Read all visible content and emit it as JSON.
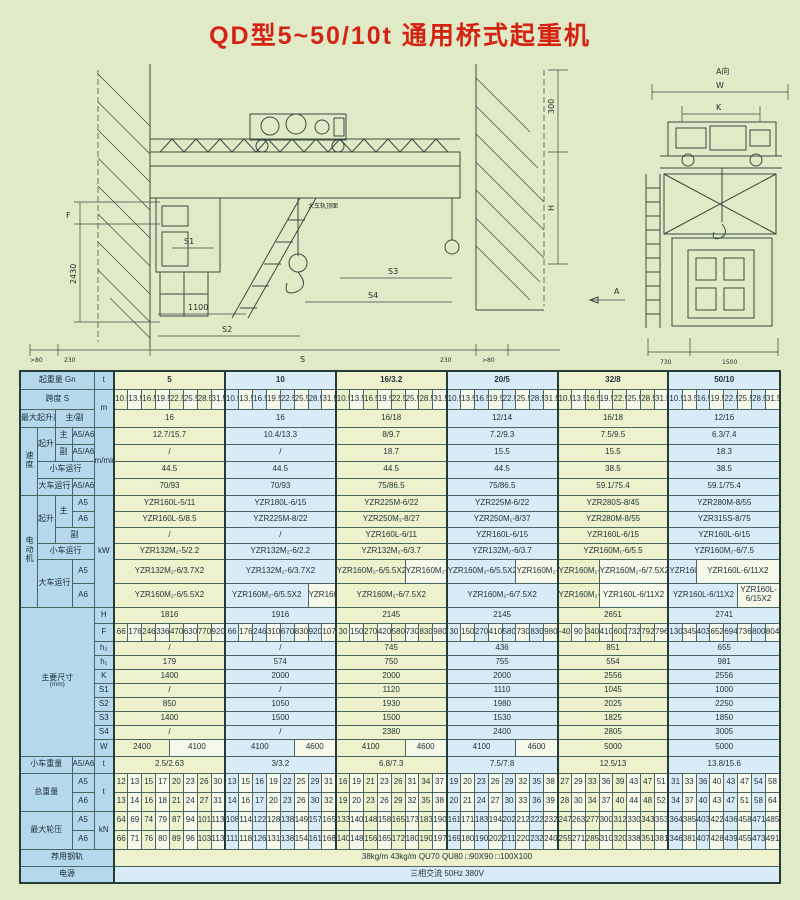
{
  "page": {
    "title": "QD型5~50/10t 通用桥式起重机"
  },
  "colors": {
    "title": "#d42313",
    "background": "#e0eac7",
    "label_bg": "#b4d9ec",
    "row_yellow": "#edf2cd",
    "row_blue": "#d9ebf7",
    "cell_white": "#f6f8ea",
    "grid": "#4a6562"
  },
  "drawing": {
    "front": {
      "f": "F",
      "h2430": "2430",
      "s1": "S1",
      "d1100": "1100",
      "s2": "S2",
      "gt80_left": ">80",
      "d230_left": "230",
      "span": "S",
      "d230_right": "230",
      "gt80_right": ">80",
      "d300": "300",
      "h": "H",
      "s3": "S3",
      "s4": "S4",
      "rail_top": "大车轨顶面",
      "section": "A"
    },
    "side": {
      "view": "A向",
      "w": "W",
      "k": "K",
      "d730": "730",
      "d1500": "1500"
    }
  },
  "table": {
    "row_labels": {
      "capacity": "起重量 Gn",
      "capacity_unit": "t",
      "span": "跨度 S",
      "span_unit": "m",
      "lift_height": "最大起升高度",
      "lift_height_sub": "主/副",
      "speed": "速度",
      "speed_unit": "m/min",
      "hoist": "起升",
      "main": "主",
      "aux": "副",
      "a5a6": "A5/A6",
      "a5": "A5",
      "a6": "A6",
      "trolley_travel": "小车运行",
      "bridge_travel": "大车运行",
      "motor": "电动机",
      "motor_unit": "kW",
      "dims": "主要尺寸",
      "dims_unit": "(mm)",
      "dim_names": [
        "H",
        "F",
        "h₂",
        "h₁",
        "K",
        "S1",
        "S2",
        "S3",
        "S4",
        "W"
      ],
      "trolley_weight": "小车重量",
      "trolley_weight_unit": "t",
      "total_weight": "总重量",
      "total_weight_unit": "t",
      "wheel_load": "最大轮压",
      "wheel_load_unit": "kN",
      "rail": "荐用钢轨",
      "power": "电源"
    },
    "capacities": [
      "5",
      "10",
      "16/3.2",
      "20/5",
      "32/8",
      "50/10"
    ],
    "spans": [
      "10.5",
      "13.5",
      "16.5",
      "19.5",
      "22.5",
      "25.5",
      "28.5",
      "31.5"
    ],
    "lift_height": [
      "16",
      "16",
      "16/18",
      "12/14",
      "16/18",
      "12/16"
    ],
    "speed_main": [
      "12.7/15.7",
      "10.4/13.3",
      "8/9.7",
      "7.2/9.3",
      "7.5/9.5",
      "6.3/7.4"
    ],
    "speed_aux": [
      "/",
      "/",
      "18.7",
      "15.5",
      "15.5",
      "18.3"
    ],
    "speed_trolley": [
      "44.5",
      "44.5",
      "44.5",
      "44.5",
      "38.5",
      "38.5"
    ],
    "speed_bridge": [
      "70/93",
      "70/93",
      "75/86.5",
      "75/86.5",
      "59.1/75.4",
      "59.1/75.4"
    ],
    "motor_main_a5": [
      "YZR160L-5/11",
      "YZR180L-6/15",
      "YZR225M-6/22",
      "YZR225M-6/22",
      "YZR280S-8/45",
      "YZR280M-8/55"
    ],
    "motor_main_a6": [
      "YZR160L-5/8.5",
      "YZR225M-8/22",
      "YZR250M₁-8/27",
      "YZR250M₁-8/37",
      "YZR280M-8/55",
      "YZR315S-8/75"
    ],
    "motor_aux": [
      "/",
      "/",
      "YZR160L-6/11",
      "YZR160L-6/15",
      "YZR160L-6/15",
      "YZR160L-6/15"
    ],
    "motor_trolley": [
      "YZR132M₂-5/2.2",
      "YZR132M₂-6/2.2",
      "YZR132M₂-6/3.7",
      "YZR132M₂-6/3.7",
      "YZR160M₁-6/5.5",
      "YZR160M₂-6/7.5"
    ],
    "motor_bridge_a5": [
      [
        "YZR132M₂-6/3.7X2"
      ],
      [
        "YZR132M₂-6/3.7X2"
      ],
      [
        "YZR160M₂-6/5.5X2",
        "YZR160M₂-6/7.5X2"
      ],
      [
        "YZR160M₂-6/5.5X2",
        "YZR160M₂-6/7.5X2"
      ],
      [
        "YZR160M₁-6/5.5X2",
        "YZR160M₂-6/7.5X2"
      ],
      [
        "YZR160M₂-6/7.5X2",
        "YZR160L-6/11X2"
      ]
    ],
    "motor_bridge_a6": [
      [
        "YZR160M₂-6/5.5X2"
      ],
      [
        "YZR160M₂-6/5.5X2",
        "YZR160M₂-6/7.5X2"
      ],
      [
        "YZR160M₂-6/7.5X2"
      ],
      [
        "YZR160M₂-6/7.5X2"
      ],
      [
        "YZR160M₂-6/7.5X2",
        "YZR160L-6/11X2"
      ],
      [
        "YZR160L-6/11X2",
        "YZR160L-6/15X2"
      ]
    ],
    "dim_H": [
      "1816",
      "1916",
      "2145",
      "2145",
      "2651",
      "2741"
    ],
    "dim_F": [
      [
        "66",
        "176",
        "246",
        "336",
        "470",
        "630",
        "770",
        "920"
      ],
      [
        "66",
        "176",
        "246",
        "310",
        "670",
        "830",
        "920",
        "1070"
      ],
      [
        "30",
        "150",
        "270",
        "420",
        "580",
        "730",
        "830",
        "980"
      ],
      [
        "30",
        "150",
        "270",
        "410",
        "580",
        "730",
        "830",
        "980"
      ],
      [
        "-40",
        "90",
        "340",
        "410",
        "600",
        "732",
        "792",
        "796"
      ],
      [
        "130",
        "345",
        "403",
        "652",
        "694",
        "736",
        "800",
        "804"
      ]
    ],
    "dim_h2": [
      "/",
      "/",
      "745",
      "436",
      "851",
      "655"
    ],
    "dim_h1": [
      "179",
      "574",
      "750",
      "755",
      "554",
      "981"
    ],
    "dim_K": [
      "1400",
      "2000",
      "2000",
      "2000",
      "2556",
      "2556"
    ],
    "dim_S1": [
      "/",
      "/",
      "1120",
      "1110",
      "1045",
      "1000"
    ],
    "dim_S2": [
      "850",
      "1050",
      "1930",
      "1980",
      "2025",
      "2250"
    ],
    "dim_S3": [
      "1400",
      "1500",
      "1500",
      "1530",
      "1825",
      "1850"
    ],
    "dim_S4": [
      "/",
      "/",
      "2380",
      "2400",
      "2805",
      "3005"
    ],
    "dim_W": [
      [
        "2400",
        "4100"
      ],
      [
        "4100",
        "4600"
      ],
      [
        "4100",
        "4600"
      ],
      [
        "4100",
        "4600"
      ],
      [
        "5000"
      ],
      [
        "5000"
      ]
    ],
    "trolley_weight": [
      "2.5/2.63",
      "3/3.2",
      "6.8/7.3",
      "7.5/7.8",
      "12.5/13",
      "13.8/15.6"
    ],
    "total_a5": [
      [
        12,
        13,
        15,
        17,
        20,
        23,
        26,
        30
      ],
      [
        13,
        15,
        16,
        19,
        22,
        25,
        29,
        31
      ],
      [
        16,
        19,
        21,
        23,
        26,
        31,
        34,
        37
      ],
      [
        19,
        20,
        23,
        26,
        29,
        32,
        35,
        38
      ],
      [
        27,
        29,
        33,
        36,
        39,
        43,
        47,
        51
      ],
      [
        31,
        33,
        36,
        40,
        43,
        47,
        54,
        58
      ]
    ],
    "total_a6": [
      [
        13,
        14,
        16,
        18,
        21,
        24,
        27,
        31
      ],
      [
        14,
        16,
        17,
        20,
        23,
        26,
        30,
        32
      ],
      [
        19,
        20,
        23,
        26,
        29,
        32,
        35,
        38
      ],
      [
        20,
        21,
        24,
        27,
        30,
        33,
        36,
        39
      ],
      [
        28,
        30,
        34,
        37,
        40,
        44,
        48,
        52
      ],
      [
        34,
        37,
        40,
        43,
        47,
        51,
        58,
        64
      ]
    ],
    "wheel_a5": [
      [
        64,
        69,
        74,
        79,
        87,
        94,
        101,
        113
      ],
      [
        108,
        114,
        122,
        128,
        138,
        149,
        157,
        165
      ],
      [
        133,
        140,
        148,
        158,
        165,
        173,
        183,
        190
      ],
      [
        161,
        171,
        183,
        194,
        202,
        212,
        222,
        232
      ],
      [
        247,
        263,
        277,
        300,
        312,
        330,
        343,
        353
      ],
      [
        364,
        385,
        403,
        422,
        436,
        458,
        471,
        485
      ]
    ],
    "wheel_a6": [
      [
        66,
        71,
        76,
        80,
        89,
        96,
        103,
        113
      ],
      [
        111,
        118,
        126,
        131,
        138,
        154,
        161,
        168
      ],
      [
        140,
        148,
        156,
        165,
        172,
        180,
        190,
        197
      ],
      [
        169,
        180,
        190,
        202,
        211,
        220,
        232,
        240
      ],
      [
        255,
        271,
        285,
        310,
        320,
        338,
        351,
        381
      ],
      [
        346,
        381,
        407,
        428,
        439,
        455,
        473,
        491
      ]
    ],
    "rail_value": "38kg/m   43kg/m   QU70   QU80   □90X90   □100X100",
    "power_value": "三相交流   50Hz   380V"
  }
}
